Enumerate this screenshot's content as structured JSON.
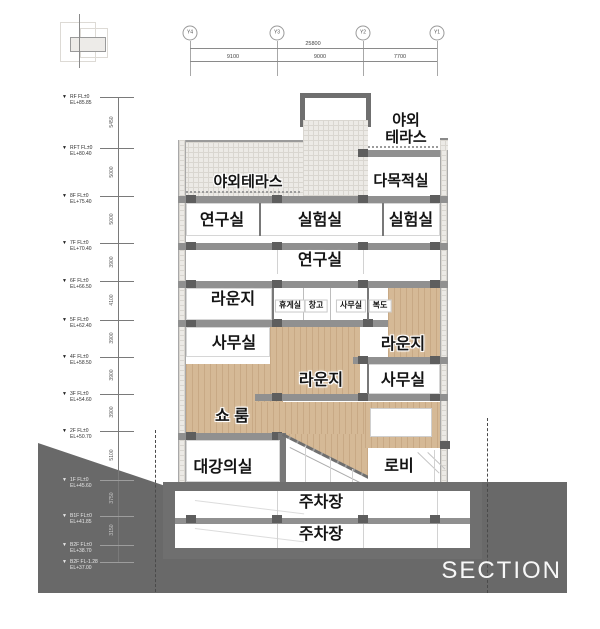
{
  "title": "SECTION",
  "grid": {
    "bubbles": [
      "Y4",
      "Y3",
      "Y2",
      "Y1"
    ],
    "total": "25800",
    "segments": [
      "9100",
      "9000",
      "7700"
    ]
  },
  "levels": [
    {
      "name": "RF FL±0",
      "el": "EL+85.85"
    },
    {
      "name": "RFT FL±0",
      "el": "EL+80.40"
    },
    {
      "name": "8F FL±0",
      "el": "EL+75.40"
    },
    {
      "name": "7F FL±0",
      "el": "EL+70.40"
    },
    {
      "name": "6F FL±0",
      "el": "EL+66.50"
    },
    {
      "name": "5F FL±0",
      "el": "EL+62.40"
    },
    {
      "name": "4F FL±0",
      "el": "EL+58.50"
    },
    {
      "name": "3F FL±0",
      "el": "EL+54.60"
    },
    {
      "name": "2F FL±0",
      "el": "EL+50.70"
    },
    {
      "name": "1F FL±0",
      "el": "EL+45.60"
    },
    {
      "name": "B1F FL±0",
      "el": "EL+41.85"
    },
    {
      "name": "B2F FL±0",
      "el": "EL+38.70"
    },
    {
      "name": "B2F FL-1.28",
      "el": "EL+37.00"
    }
  ],
  "vdims": [
    "5450",
    "5000",
    "5000",
    "3900",
    "4100",
    "3900",
    "3900",
    "3900",
    "5100",
    "3750",
    "3150"
  ],
  "rooms": {
    "terrace_upper": "야외\n테라스",
    "terrace_left": "야외테라스",
    "multipurpose": "다목적실",
    "research_a": "연구실",
    "lab_a": "실험실",
    "lab_b": "실험실",
    "research_b": "연구실",
    "lounge_a": "라운지",
    "rest": "휴게실",
    "storage": "창고",
    "office_a": "사무실",
    "corridor": "복도",
    "office_b": "사무실",
    "lounge_b": "라운지",
    "lounge_c": "라운지",
    "office_c": "사무실",
    "showroom": "쇼 룸",
    "lecture": "대강의실",
    "lobby": "로비",
    "parking_b1": "주차장",
    "parking_b2": "주차장"
  },
  "colors": {
    "terrain": "#696969",
    "slab": "#909090",
    "wood": "#d5b996",
    "hatch": "#eceae6",
    "label": "#141414",
    "section_title": "#f7f7f7"
  }
}
